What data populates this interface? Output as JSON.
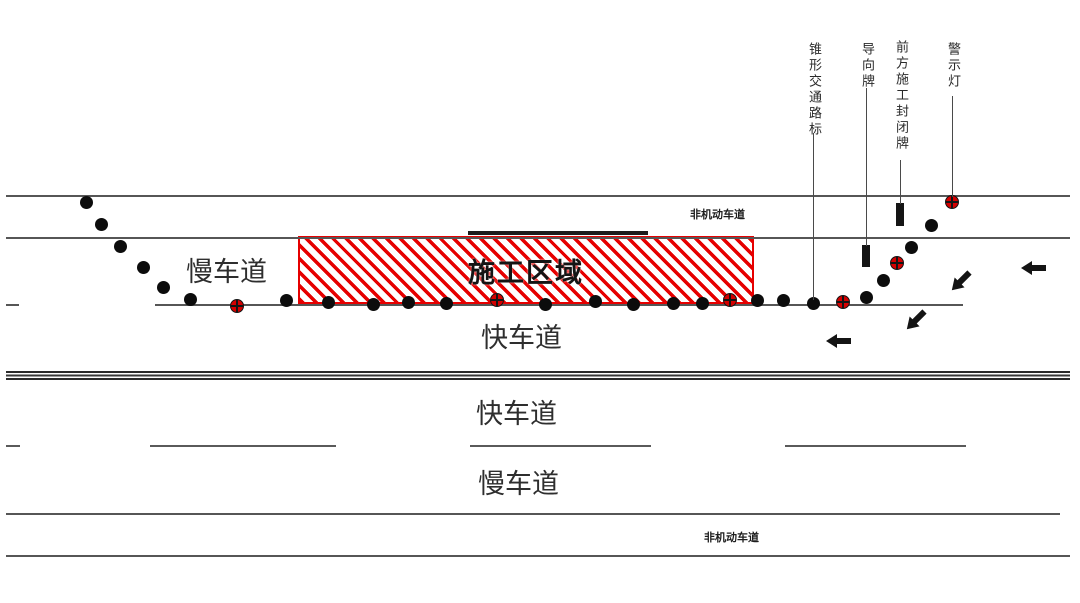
{
  "diagram": {
    "title": "道路施工区交通布置示意图",
    "colors": {
      "construction_red": "#e60000",
      "road_line_gray": "#565656",
      "element_black": "#141414",
      "background": "#ffffff"
    },
    "lane_labels": {
      "top_nonmotor": "非机动车道",
      "top_slow": "慢车道",
      "top_fast": "快车道",
      "bottom_fast": "快车道",
      "bottom_slow": "慢车道",
      "bottom_nonmotor": "非机动车道"
    },
    "construction_zone": {
      "label": "施工区域",
      "x": 298,
      "y": 236,
      "width": 456,
      "height": 68
    },
    "barrier_bar": {
      "x": 468,
      "y": 231,
      "width": 180,
      "height": 4
    },
    "callouts": [
      {
        "id": "traffic-cone-callout",
        "label": "锥形交通路标",
        "x": 813,
        "label_top": 42,
        "line_top": 133,
        "line_bottom": 300
      },
      {
        "id": "guide-sign-callout",
        "label": "导向牌",
        "x": 866,
        "label_top": 42,
        "line_top": 88,
        "line_bottom": 246
      },
      {
        "id": "closure-sign-callout",
        "label": "前方施工封闭牌",
        "x": 900,
        "label_top": 40,
        "line_top": 160,
        "line_bottom": 204
      },
      {
        "id": "warning-light-callout",
        "label": "警示灯",
        "x": 952,
        "label_top": 42,
        "line_top": 96,
        "line_bottom": 197
      }
    ],
    "road_lines": [
      {
        "name": "top-road-edge-line",
        "x1": 6,
        "x2": 1070,
        "y": 195,
        "h": 2
      },
      {
        "name": "top-nonmotor-divider-line",
        "x1": 6,
        "x2": 1070,
        "y": 237,
        "h": 2
      },
      {
        "name": "top-lane-divider-dash-left",
        "x1": 6,
        "x2": 19,
        "y": 304,
        "h": 2
      },
      {
        "name": "top-lane-divider-line",
        "x1": 155,
        "x2": 963,
        "y": 304,
        "h": 2
      },
      {
        "name": "bottom-nonmotor-divider-line",
        "x1": 6,
        "x2": 1060,
        "y": 513,
        "h": 2
      },
      {
        "name": "bottom-road-edge-line",
        "x1": 6,
        "x2": 1070,
        "y": 555,
        "h": 2
      }
    ],
    "center_double_line": {
      "x1": 6,
      "x2": 1070,
      "y": 371,
      "h": 9
    },
    "dashed_lane_line": {
      "y": 445,
      "h": 2,
      "segments": [
        [
          6,
          20
        ],
        [
          150,
          336
        ],
        [
          470,
          651
        ],
        [
          785,
          966
        ]
      ]
    },
    "cones": [
      [
        86,
        202
      ],
      [
        101,
        224
      ],
      [
        120,
        246
      ],
      [
        143,
        267
      ],
      [
        163,
        287
      ],
      [
        190,
        299
      ],
      [
        286,
        300
      ],
      [
        328,
        302
      ],
      [
        373,
        304
      ],
      [
        408,
        302
      ],
      [
        446,
        303
      ],
      [
        545,
        304
      ],
      [
        595,
        301
      ],
      [
        633,
        304
      ],
      [
        673,
        303
      ],
      [
        702,
        303
      ],
      [
        757,
        300
      ],
      [
        783,
        300
      ],
      [
        813,
        303
      ],
      [
        866,
        297
      ],
      [
        883,
        280
      ],
      [
        911,
        247
      ],
      [
        931,
        225
      ]
    ],
    "warning_lights": [
      [
        237,
        306
      ],
      [
        497,
        300
      ],
      [
        730,
        300
      ],
      [
        843,
        302
      ],
      [
        897,
        263
      ],
      [
        952,
        202
      ]
    ],
    "signs": [
      {
        "name": "closure-sign-board",
        "x": 896,
        "y": 203,
        "width": 8,
        "height": 23
      },
      {
        "name": "guide-sign-board",
        "x": 862,
        "y": 245,
        "width": 8,
        "height": 22
      }
    ],
    "arrows": [
      {
        "cx": 1034,
        "cy": 268,
        "rotation": 180
      },
      {
        "cx": 961,
        "cy": 281,
        "rotation": 135
      },
      {
        "cx": 916,
        "cy": 320,
        "rotation": 135
      },
      {
        "cx": 839,
        "cy": 341,
        "rotation": 180
      }
    ]
  }
}
